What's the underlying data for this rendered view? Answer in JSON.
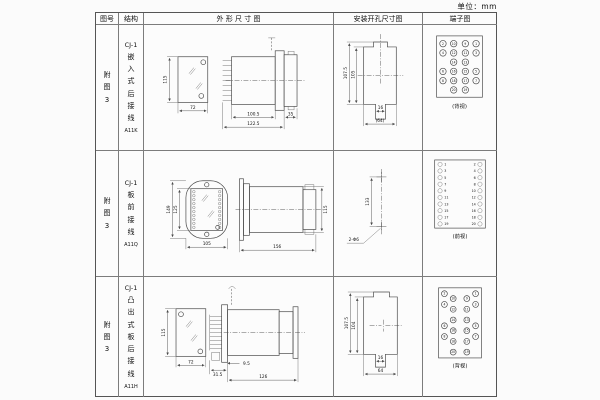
{
  "unit_label": "单位：mm",
  "table": {
    "headers": [
      "图号",
      "结构",
      "外 形 尺 寸 图",
      "安装开孔尺寸图",
      "端子图"
    ],
    "rows": [
      {
        "figure_no": "附图3",
        "structure_title": "CJ-1",
        "structure_name": "嵌入式后接线",
        "model": "A11K",
        "outline": {
          "front_height": "115",
          "front_width": "72",
          "depth_a": "100.5",
          "depth_total": "122.5",
          "flange_depth": "35"
        },
        "install": {
          "height_outer": "107.5",
          "height_inner": "105",
          "slot_width": "16",
          "width_total": "(64)"
        },
        "terminal": {
          "caption": "(背视)",
          "numbers": [
            "2",
            "10",
            "9",
            "1",
            "4",
            "12",
            "11",
            "3",
            "14",
            "13",
            "6",
            "16",
            "15",
            "5",
            "8",
            "18",
            "17",
            "7",
            "20",
            "19"
          ]
        }
      },
      {
        "figure_no": "附图3",
        "structure_title": "CJ-1",
        "structure_name": "板前接线",
        "model": "A11Q",
        "outline": {
          "front_height_outer": "149",
          "front_height_inner": "125",
          "front_width": "105",
          "depth_total": "156",
          "side_height": "115"
        },
        "install": {
          "hole_spacing": "133",
          "hole_label": "2-Φ6"
        },
        "terminal": {
          "caption": "(前视)",
          "left_numbers": [
            "1",
            "3",
            "5",
            "7",
            "9",
            "11",
            "13",
            "15",
            "17",
            "19"
          ],
          "right_numbers": [
            "2",
            "4",
            "6",
            "8",
            "10",
            "12",
            "14",
            "16",
            "18",
            "20"
          ]
        }
      },
      {
        "figure_no": "附图3",
        "structure_title": "CJ-1",
        "structure_name": "凸出式板后接线",
        "model": "A11H",
        "outline": {
          "front_height": "115",
          "front_width": "72",
          "dim_a": "31.5",
          "dim_b": "9.5",
          "depth_total": "126"
        },
        "install": {
          "height_outer": "107.5",
          "height_inner": "104",
          "slot_width": "16",
          "width_total": "64"
        },
        "terminal": {
          "caption": "(背视)",
          "left_outer": [
            "2",
            "4",
            "6",
            "8"
          ],
          "left_inner": [
            "10",
            "12",
            "14",
            "16",
            "18",
            "20"
          ],
          "right_inner": [
            "9",
            "11",
            "13",
            "15",
            "17",
            "19"
          ],
          "right_outer": [
            "1",
            "3",
            "5",
            "7"
          ]
        }
      }
    ]
  }
}
